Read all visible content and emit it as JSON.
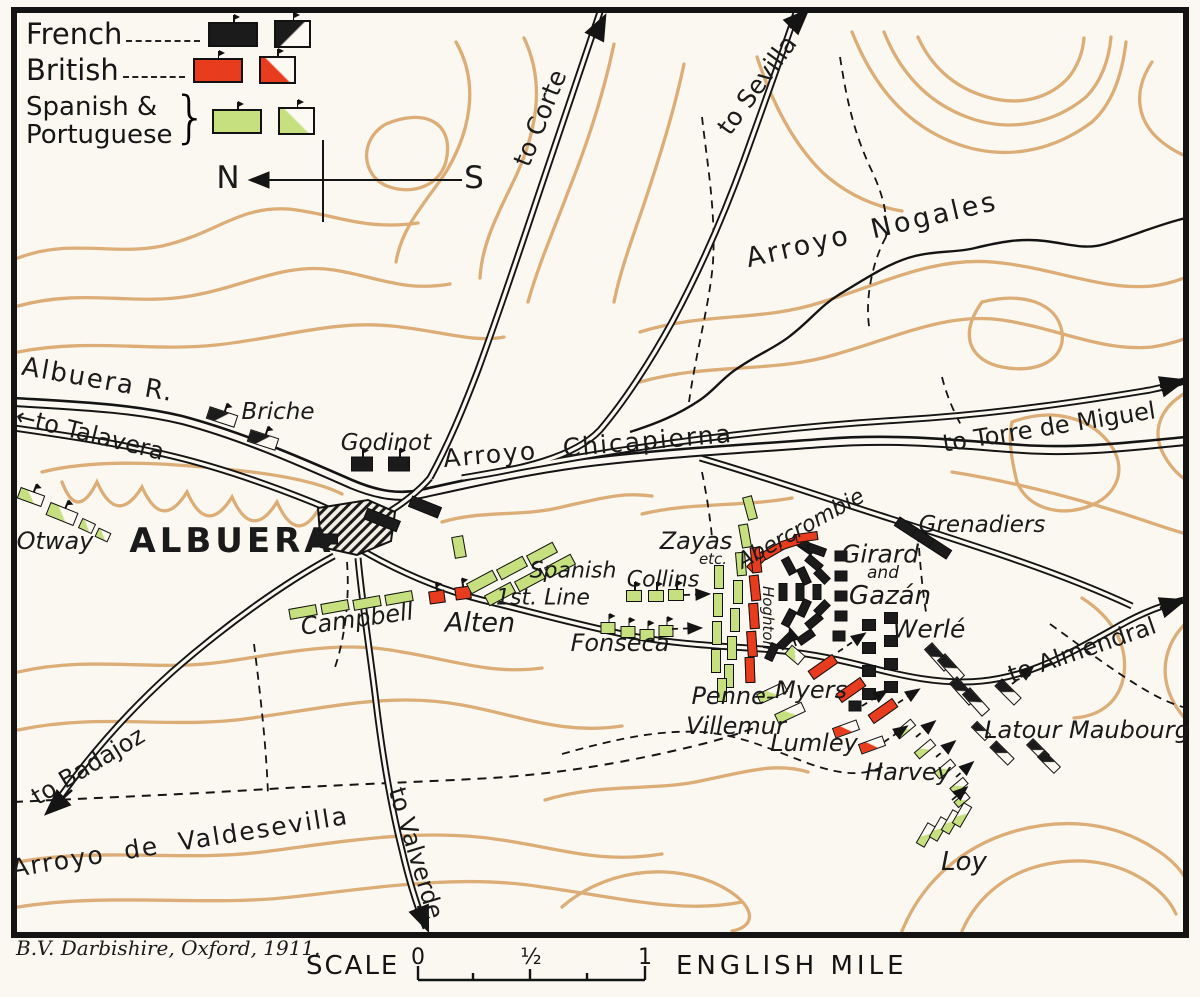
{
  "title": "Battle of Albuera map",
  "colors": {
    "paper": "#faf8f0",
    "ink": "#141414",
    "contour": "#d9a56b",
    "french": "#1b1b1b",
    "british": "#e83c1e",
    "spanish_portuguese": "#c6e07f"
  },
  "legend": {
    "french": "French",
    "british": "British",
    "spanish_line1": "Spanish &",
    "spanish_line2": "Portuguese",
    "brace": "}"
  },
  "scale_bar": {
    "title": "SCALE",
    "tick0": "0",
    "tick_half": "½",
    "tick1": "1",
    "unit": "ENGLISH MILE"
  },
  "credit": "B.V. Darbishire, Oxford, 1911.",
  "labels": [
    {
      "text": "N",
      "x": 228,
      "y": 178,
      "fs": 31,
      "cls": "cmp"
    },
    {
      "text": "S",
      "x": 474,
      "y": 178,
      "fs": 31,
      "cls": "cmp"
    },
    {
      "text": "to Corte",
      "x": 540,
      "y": 118,
      "fs": 25,
      "rot": -68,
      "cls": "road"
    },
    {
      "text": "to Sevilla",
      "x": 757,
      "y": 85,
      "fs": 25,
      "rot": -54,
      "cls": "road"
    },
    {
      "text": "Arroyo Nogales",
      "x": 872,
      "y": 230,
      "fs": 27,
      "rot": -13,
      "cls": "river",
      "ls": 3,
      "ws": 10
    },
    {
      "text": "Albuera R.",
      "x": 98,
      "y": 380,
      "fs": 26,
      "rot": 10,
      "cls": "river",
      "ls": 2
    },
    {
      "text": "←to Talavera",
      "x": 90,
      "y": 434,
      "fs": 24,
      "rot": 14,
      "cls": "road"
    },
    {
      "text": "Briche",
      "x": 278,
      "y": 412,
      "fs": 23,
      "cls": "u"
    },
    {
      "text": "Godinot",
      "x": 386,
      "y": 443,
      "fs": 23,
      "cls": "u"
    },
    {
      "text": "Arroyo Chicapierna",
      "x": 588,
      "y": 446,
      "fs": 25,
      "rot": -5,
      "cls": "river",
      "ls": 2,
      "ws": 16
    },
    {
      "text": "to Torre de Miguel",
      "x": 1049,
      "y": 427,
      "fs": 24,
      "rot": -9,
      "cls": "road"
    },
    {
      "text": "Grenadiers",
      "x": 982,
      "y": 525,
      "fs": 23,
      "cls": "u"
    },
    {
      "text": "ALBUERA",
      "x": 232,
      "y": 541,
      "fs": 34,
      "cls": "town",
      "ls": 4
    },
    {
      "text": "Otway",
      "x": 55,
      "y": 541,
      "fs": 24,
      "cls": "u"
    },
    {
      "text": "Campbell",
      "x": 357,
      "y": 619,
      "fs": 24,
      "rot": -8,
      "cls": "u"
    },
    {
      "text": "Alten",
      "x": 480,
      "y": 623,
      "fs": 27,
      "cls": "u"
    },
    {
      "text": "Spanish",
      "x": 573,
      "y": 571,
      "fs": 22,
      "cls": "u"
    },
    {
      "text": "1st. Line",
      "x": 543,
      "y": 598,
      "fs": 22,
      "cls": "u"
    },
    {
      "text": "Collins",
      "x": 663,
      "y": 580,
      "fs": 22,
      "cls": "u"
    },
    {
      "text": "Fonseca",
      "x": 620,
      "y": 643,
      "fs": 24,
      "cls": "u"
    },
    {
      "text": "Zayas",
      "x": 696,
      "y": 541,
      "fs": 24,
      "cls": "u"
    },
    {
      "text": "etc.",
      "x": 713,
      "y": 559,
      "fs": 15,
      "cls": "u"
    },
    {
      "text": "Abercrombie",
      "x": 801,
      "y": 529,
      "fs": 22,
      "rot": -29,
      "cls": "u"
    },
    {
      "text": "Girard",
      "x": 880,
      "y": 554,
      "fs": 25,
      "cls": "u"
    },
    {
      "text": "and",
      "x": 883,
      "y": 573,
      "fs": 17,
      "cls": "u"
    },
    {
      "text": "Gazán",
      "x": 890,
      "y": 596,
      "fs": 26,
      "cls": "u"
    },
    {
      "text": "Werlé",
      "x": 929,
      "y": 629,
      "fs": 25,
      "cls": "u"
    },
    {
      "text": "Hoghton",
      "x": 768,
      "y": 618,
      "fs": 15,
      "rot": 90,
      "cls": "u"
    },
    {
      "text": "Myers",
      "x": 811,
      "y": 690,
      "fs": 24,
      "cls": "u"
    },
    {
      "text": "Penne-",
      "x": 733,
      "y": 696,
      "fs": 24,
      "cls": "u"
    },
    {
      "text": "Villemur",
      "x": 736,
      "y": 726,
      "fs": 24,
      "cls": "u"
    },
    {
      "text": "Lumley",
      "x": 814,
      "y": 743,
      "fs": 24,
      "cls": "u"
    },
    {
      "text": "Harvey",
      "x": 908,
      "y": 772,
      "fs": 24,
      "cls": "u"
    },
    {
      "text": "Latour Maubourg",
      "x": 1087,
      "y": 730,
      "fs": 24,
      "cls": "u"
    },
    {
      "text": "Loy",
      "x": 964,
      "y": 862,
      "fs": 26,
      "cls": "u"
    },
    {
      "text": "to Almendral",
      "x": 1082,
      "y": 650,
      "fs": 24,
      "rot": -19,
      "cls": "road"
    },
    {
      "text": "to Badajoz",
      "x": 88,
      "y": 766,
      "fs": 24,
      "rot": -31,
      "cls": "road"
    },
    {
      "text": "Arroyo de Valdesevilla",
      "x": 180,
      "y": 842,
      "fs": 25,
      "rot": -9,
      "cls": "river",
      "ls": 2,
      "ws": 10
    },
    {
      "text": "to Valverde",
      "x": 416,
      "y": 853,
      "fs": 24,
      "rot": 73,
      "cls": "road"
    }
  ],
  "units_format": "[army f/b/s, kind so(solid)/sp(split-cavalry), x, y, w, h, rot, flag]",
  "units": [
    [
      "f",
      "sp",
      222,
      417,
      30,
      13,
      18,
      1
    ],
    [
      "f",
      "sp",
      263,
      440,
      30,
      13,
      18,
      1
    ],
    [
      "f",
      "so",
      362,
      464,
      22,
      15,
      0,
      1
    ],
    [
      "f",
      "so",
      399,
      464,
      22,
      15,
      0,
      1
    ],
    [
      "f",
      "so",
      382,
      520,
      36,
      12,
      22,
      0
    ],
    [
      "f",
      "so",
      425,
      507,
      32,
      12,
      22,
      0
    ],
    [
      "f",
      "so",
      325,
      539,
      26,
      11,
      0,
      0
    ],
    [
      "f",
      "so",
      906,
      527,
      22,
      11,
      33,
      0
    ],
    [
      "f",
      "so",
      923,
      538,
      22,
      11,
      33,
      0
    ],
    [
      "f",
      "so",
      940,
      549,
      22,
      11,
      33,
      0
    ],
    [
      "f",
      "so",
      806,
      547,
      18,
      9,
      35,
      0
    ],
    [
      "f",
      "so",
      789,
      566,
      18,
      9,
      62,
      0
    ],
    [
      "f",
      "so",
      783,
      592,
      18,
      9,
      90,
      0
    ],
    [
      "f",
      "so",
      789,
      618,
      18,
      9,
      118,
      0
    ],
    [
      "f",
      "so",
      806,
      637,
      18,
      9,
      145,
      0
    ],
    [
      "f",
      "so",
      814,
      563,
      18,
      9,
      40,
      0
    ],
    [
      "f",
      "so",
      804,
      576,
      18,
      9,
      65,
      0
    ],
    [
      "f",
      "so",
      800,
      592,
      18,
      9,
      90,
      0
    ],
    [
      "f",
      "so",
      804,
      608,
      18,
      9,
      115,
      0
    ],
    [
      "f",
      "so",
      814,
      621,
      18,
      9,
      140,
      0
    ],
    [
      "f",
      "so",
      822,
      576,
      16,
      9,
      45,
      0
    ],
    [
      "f",
      "so",
      817,
      592,
      16,
      9,
      90,
      0
    ],
    [
      "f",
      "so",
      822,
      608,
      16,
      9,
      135,
      0
    ],
    [
      "f",
      "so",
      800,
      542,
      18,
      9,
      30,
      0
    ],
    [
      "f",
      "so",
      817,
      550,
      18,
      9,
      20,
      0
    ],
    [
      "f",
      "so",
      841,
      556,
      13,
      11,
      0,
      0
    ],
    [
      "f",
      "so",
      841,
      576,
      13,
      11,
      0,
      0
    ],
    [
      "f",
      "so",
      841,
      596,
      13,
      11,
      0,
      0
    ],
    [
      "f",
      "so",
      841,
      616,
      13,
      11,
      0,
      0
    ],
    [
      "f",
      "so",
      839,
      636,
      13,
      11,
      0,
      0
    ],
    [
      "f",
      "so",
      786,
      641,
      18,
      9,
      135,
      0
    ],
    [
      "f",
      "so",
      772,
      652,
      18,
      9,
      115,
      0
    ],
    [
      "f",
      "so",
      869,
      625,
      14,
      12,
      0,
      0
    ],
    [
      "f",
      "so",
      869,
      648,
      14,
      12,
      0,
      0
    ],
    [
      "f",
      "so",
      869,
      671,
      14,
      12,
      0,
      0
    ],
    [
      "f",
      "so",
      869,
      694,
      14,
      12,
      0,
      0
    ],
    [
      "f",
      "so",
      891,
      618,
      14,
      12,
      0,
      0
    ],
    [
      "f",
      "so",
      891,
      641,
      14,
      12,
      0,
      0
    ],
    [
      "f",
      "so",
      891,
      664,
      14,
      12,
      0,
      0
    ],
    [
      "f",
      "so",
      891,
      687,
      14,
      12,
      0,
      0
    ],
    [
      "f",
      "so",
      855,
      706,
      13,
      11,
      0,
      0
    ],
    [
      "f",
      "sp",
      938,
      657,
      30,
      11,
      48,
      0
    ],
    [
      "f",
      "sp",
      951,
      668,
      30,
      11,
      48,
      0
    ],
    [
      "f",
      "sp",
      963,
      691,
      30,
      11,
      48,
      0
    ],
    [
      "f",
      "sp",
      976,
      702,
      30,
      11,
      48,
      0
    ],
    [
      "f",
      "sp",
      1008,
      692,
      28,
      11,
      45,
      0
    ],
    [
      "f",
      "sp",
      981,
      731,
      20,
      9,
      45,
      0
    ],
    [
      "f",
      "sp",
      1002,
      753,
      26,
      10,
      45,
      0
    ],
    [
      "f",
      "sp",
      1038,
      750,
      24,
      10,
      45,
      0
    ],
    [
      "f",
      "sp",
      1049,
      762,
      24,
      10,
      45,
      0
    ],
    [
      "b",
      "so",
      437,
      597,
      16,
      13,
      -8,
      1
    ],
    [
      "b",
      "so",
      463,
      593,
      16,
      13,
      -8,
      1
    ],
    [
      "b",
      "so",
      757,
      562,
      22,
      9,
      -45,
      0
    ],
    [
      "b",
      "so",
      773,
      551,
      22,
      9,
      -30,
      0
    ],
    [
      "b",
      "so",
      790,
      543,
      22,
      9,
      -18,
      0
    ],
    [
      "b",
      "so",
      807,
      537,
      22,
      9,
      -8,
      0
    ],
    [
      "b",
      "so",
      756,
      560,
      10,
      26,
      -6,
      0
    ],
    [
      "b",
      "so",
      755,
      588,
      10,
      26,
      -6,
      0
    ],
    [
      "b",
      "so",
      754,
      616,
      10,
      26,
      -4,
      0
    ],
    [
      "b",
      "so",
      752,
      644,
      10,
      26,
      -4,
      0
    ],
    [
      "b",
      "so",
      750,
      670,
      10,
      26,
      -2,
      0
    ],
    [
      "b",
      "so",
      823,
      667,
      30,
      11,
      -35,
      0
    ],
    [
      "b",
      "so",
      851,
      690,
      30,
      11,
      -35,
      0
    ],
    [
      "b",
      "so",
      883,
      711,
      30,
      11,
      -35,
      0
    ],
    [
      "b",
      "sp",
      846,
      729,
      26,
      11,
      -20,
      0
    ],
    [
      "b",
      "sp",
      872,
      745,
      26,
      11,
      -20,
      0
    ],
    [
      "s",
      "sp",
      31,
      497,
      26,
      12,
      20,
      1
    ],
    [
      "s",
      "sp",
      62,
      514,
      30,
      14,
      22,
      1
    ],
    [
      "s",
      "sp",
      87,
      526,
      15,
      11,
      25,
      0
    ],
    [
      "s",
      "sp",
      103,
      535,
      14,
      10,
      25,
      0
    ],
    [
      "s",
      "so",
      303,
      612,
      28,
      11,
      -10,
      0
    ],
    [
      "s",
      "so",
      335,
      607,
      28,
      11,
      -10,
      0
    ],
    [
      "s",
      "so",
      367,
      603,
      28,
      11,
      -10,
      0
    ],
    [
      "s",
      "so",
      399,
      598,
      28,
      11,
      -10,
      0
    ],
    [
      "s",
      "so",
      482,
      582,
      30,
      12,
      -28,
      0
    ],
    [
      "s",
      "so",
      512,
      568,
      30,
      12,
      -28,
      0
    ],
    [
      "s",
      "so",
      542,
      554,
      30,
      12,
      -28,
      0
    ],
    [
      "s",
      "so",
      500,
      594,
      30,
      12,
      -28,
      0
    ],
    [
      "s",
      "so",
      530,
      580,
      30,
      12,
      -28,
      0
    ],
    [
      "s",
      "so",
      560,
      566,
      30,
      12,
      -28,
      0
    ],
    [
      "s",
      "so",
      459,
      547,
      12,
      22,
      -10,
      0
    ],
    [
      "s",
      "so",
      634,
      596,
      16,
      12,
      0,
      1
    ],
    [
      "s",
      "so",
      656,
      596,
      16,
      12,
      0,
      1
    ],
    [
      "s",
      "so",
      676,
      595,
      16,
      12,
      0,
      1
    ],
    [
      "s",
      "so",
      608,
      628,
      15,
      12,
      0,
      1
    ],
    [
      "s",
      "so",
      628,
      632,
      15,
      12,
      0,
      1
    ],
    [
      "s",
      "so",
      647,
      635,
      15,
      12,
      0,
      1
    ],
    [
      "s",
      "so",
      666,
      631,
      15,
      12,
      0,
      1
    ],
    [
      "s",
      "so",
      750,
      508,
      10,
      24,
      -15,
      0
    ],
    [
      "s",
      "so",
      745,
      536,
      10,
      24,
      -10,
      0
    ],
    [
      "s",
      "so",
      741,
      564,
      10,
      24,
      -5,
      0
    ],
    [
      "s",
      "so",
      738,
      592,
      10,
      24,
      0,
      0
    ],
    [
      "s",
      "so",
      735,
      620,
      10,
      24,
      0,
      0
    ],
    [
      "s",
      "so",
      732,
      648,
      10,
      24,
      0,
      0
    ],
    [
      "s",
      "so",
      729,
      676,
      10,
      24,
      0,
      0
    ],
    [
      "s",
      "so",
      719,
      577,
      10,
      24,
      0,
      0
    ],
    [
      "s",
      "so",
      718,
      605,
      10,
      24,
      0,
      0
    ],
    [
      "s",
      "so",
      717,
      633,
      10,
      24,
      0,
      0
    ],
    [
      "s",
      "so",
      716,
      661,
      10,
      24,
      0,
      0
    ],
    [
      "s",
      "so",
      722,
      690,
      10,
      24,
      0,
      0
    ],
    [
      "s",
      "sp",
      772,
      693,
      30,
      11,
      -25,
      0
    ],
    [
      "s",
      "sp",
      790,
      713,
      30,
      11,
      -25,
      0
    ],
    [
      "s",
      "sp",
      795,
      655,
      18,
      12,
      40,
      0
    ],
    [
      "s",
      "sp",
      905,
      729,
      22,
      9,
      -40,
      0
    ],
    [
      "s",
      "sp",
      925,
      749,
      22,
      9,
      -40,
      0
    ],
    [
      "s",
      "sp",
      945,
      769,
      22,
      9,
      -40,
      0
    ],
    [
      "s",
      "sp",
      959,
      786,
      18,
      9,
      -40,
      0
    ],
    [
      "s",
      "sp",
      962,
      800,
      16,
      8,
      -40,
      0
    ],
    [
      "s",
      "sp",
      926,
      835,
      24,
      10,
      -60,
      0
    ],
    [
      "s",
      "sp",
      939,
      829,
      24,
      10,
      -60,
      0
    ],
    [
      "s",
      "sp",
      951,
      822,
      24,
      10,
      -60,
      0
    ],
    [
      "s",
      "sp",
      962,
      815,
      24,
      10,
      -60,
      0
    ]
  ],
  "arrows_format": "[x1,y1,x2,y2] dashed movement arrows",
  "arrows": [
    [
      684,
      595,
      708,
      594
    ],
    [
      672,
      629,
      700,
      628
    ],
    [
      838,
      652,
      864,
      634
    ],
    [
      884,
      742,
      906,
      727
    ],
    [
      862,
      706,
      886,
      691
    ],
    [
      916,
      737,
      934,
      722
    ],
    [
      936,
      757,
      954,
      742
    ],
    [
      956,
      777,
      972,
      763
    ],
    [
      952,
      800,
      966,
      788
    ],
    [
      796,
      646,
      790,
      629
    ],
    [
      898,
      703,
      918,
      690
    ],
    [
      1012,
      684,
      1032,
      668
    ]
  ]
}
